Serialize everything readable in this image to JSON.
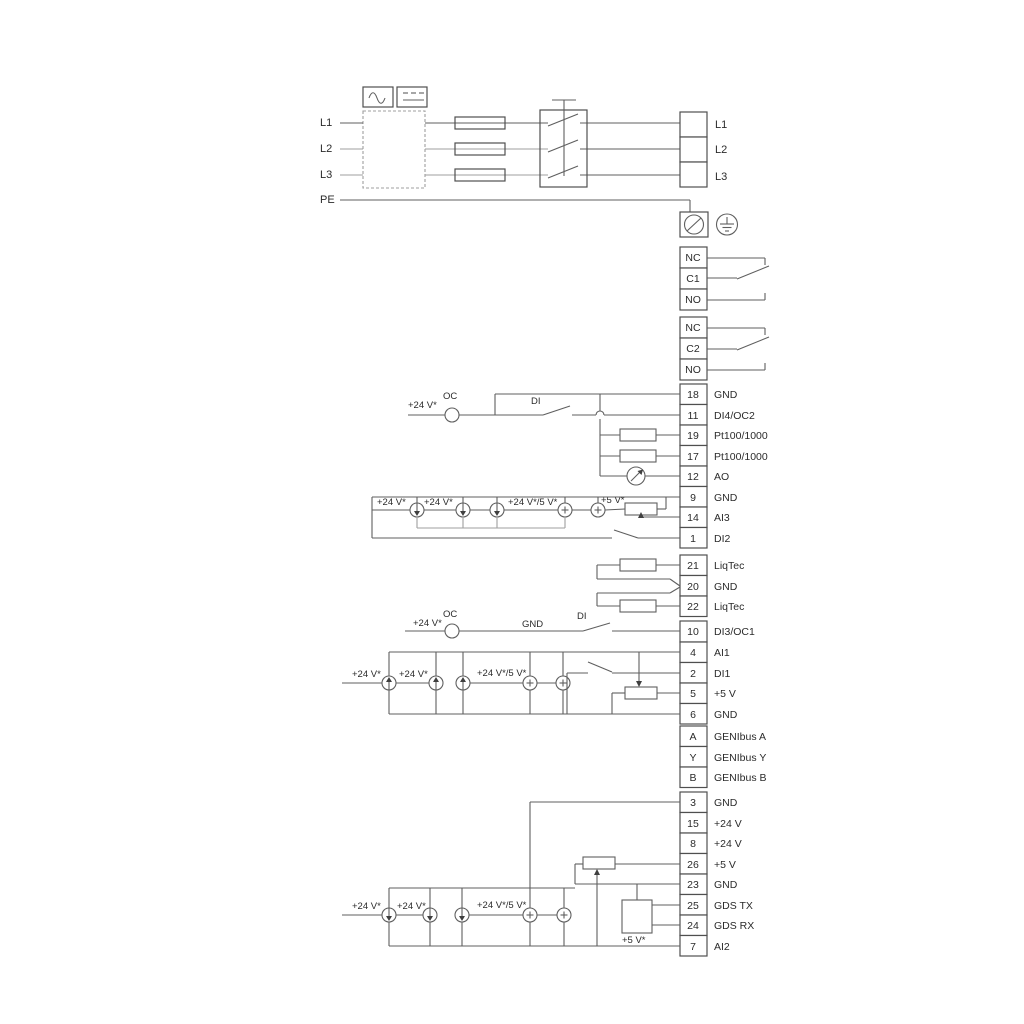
{
  "colors": {
    "wire": "#5f5f5f",
    "wire_alt": "#9f9f9f",
    "text": "#2b2b2b",
    "background": "#ffffff"
  },
  "power": {
    "left": [
      "L1",
      "L2",
      "L3",
      "PE"
    ],
    "right": [
      "L1",
      "L2",
      "L3"
    ]
  },
  "relays": [
    [
      "NC",
      "C1",
      "NO"
    ],
    [
      "NC",
      "C2",
      "NO"
    ]
  ],
  "terminals": {
    "a": [
      {
        "n": "18",
        "l": "GND"
      },
      {
        "n": "11",
        "l": "DI4/OC2"
      },
      {
        "n": "19",
        "l": "Pt100/1000"
      },
      {
        "n": "17",
        "l": "Pt100/1000"
      },
      {
        "n": "12",
        "l": "AO"
      },
      {
        "n": "9",
        "l": "GND"
      },
      {
        "n": "14",
        "l": "AI3"
      },
      {
        "n": "1",
        "l": "DI2"
      }
    ],
    "b": [
      {
        "n": "21",
        "l": "LiqTec"
      },
      {
        "n": "20",
        "l": "GND"
      },
      {
        "n": "22",
        "l": "LiqTec"
      }
    ],
    "c": [
      {
        "n": "10",
        "l": "DI3/OC1"
      }
    ],
    "d": [
      {
        "n": "4",
        "l": "AI1"
      },
      {
        "n": "2",
        "l": "DI1"
      },
      {
        "n": "5",
        "l": "+5 V"
      },
      {
        "n": "6",
        "l": "GND"
      }
    ],
    "e": [
      {
        "n": "A",
        "l": "GENIbus A"
      },
      {
        "n": "Y",
        "l": "GENIbus Y"
      },
      {
        "n": "B",
        "l": "GENIbus B"
      }
    ],
    "f": [
      {
        "n": "3",
        "l": "GND"
      },
      {
        "n": "15",
        "l": "+24 V"
      },
      {
        "n": "8",
        "l": "+24 V"
      },
      {
        "n": "26",
        "l": "+5 V"
      },
      {
        "n": "23",
        "l": "GND"
      },
      {
        "n": "25",
        "l": "GDS TX"
      },
      {
        "n": "24",
        "l": "GDS RX"
      },
      {
        "n": "7",
        "l": "AI2"
      }
    ]
  },
  "ann": {
    "di4": {
      "v24": "+24 V*",
      "oc": "OC",
      "di": "DI"
    },
    "ai3": {
      "v24a": "+24 V*",
      "v24b": "+24 V*",
      "v245": "+24 V*/5 V*",
      "v5": "+5 V*"
    },
    "di3": {
      "v24": "+24 V*",
      "oc": "OC",
      "gnd": "GND",
      "di": "DI"
    },
    "ai1": {
      "v24a": "+24 V*",
      "v24b": "+24 V*",
      "v245": "+24 V*/5 V*"
    },
    "ai2": {
      "v24a": "+24 V*",
      "v24b": "+24 V*",
      "v245": "+24 V*/5 V*",
      "v5": "+5 V*"
    }
  }
}
